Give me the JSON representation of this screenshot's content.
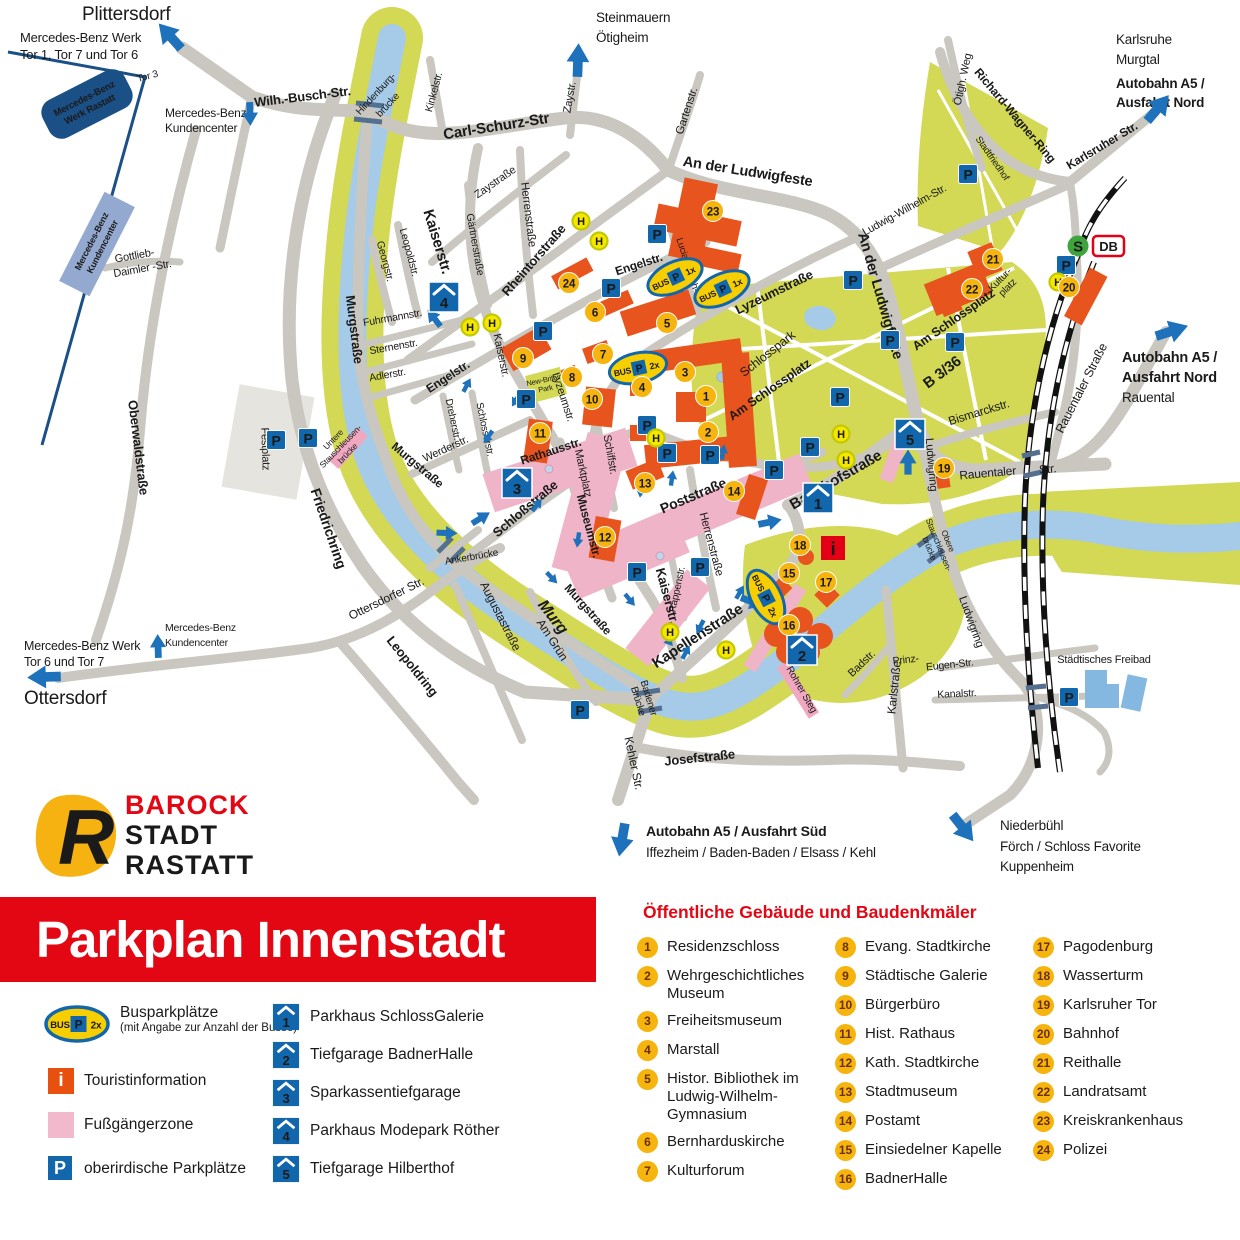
{
  "banner": {
    "title": "Parkplan Innenstadt"
  },
  "logo": {
    "word1": "BAROCK",
    "word2": "STADT",
    "word3": "RASTATT",
    "letter": "R"
  },
  "legend": {
    "bus_label": "Busparkplätze",
    "bus_sublabel": "(mit Angabe zur Anzahl der Busse)",
    "bus_word": "BUS",
    "p_letter": "P",
    "bus_count_legend": "2x",
    "touristinfo": "Touristinformation",
    "touristinfo_icon": "i",
    "fussgaengerzone": "Fußgängerzone",
    "parkplaetze": "oberirdische Parkplätze"
  },
  "garages": [
    {
      "num": "1",
      "name": "Parkhaus SchlossGalerie"
    },
    {
      "num": "2",
      "name": "Tiefgarage BadnerHalle"
    },
    {
      "num": "3",
      "name": "Sparkassentiefgarage"
    },
    {
      "num": "4",
      "name": "Parkhaus Modepark Röther"
    },
    {
      "num": "5",
      "name": "Tiefgarage Hilberthof"
    }
  ],
  "buildings": {
    "heading": "Öffentliche Gebäude und Baudenkmäler",
    "items": [
      {
        "num": "1",
        "name": "Residenzschloss"
      },
      {
        "num": "2",
        "name": "Wehrgeschichtliches Museum"
      },
      {
        "num": "3",
        "name": "Freiheitsmuseum"
      },
      {
        "num": "4",
        "name": "Marstall"
      },
      {
        "num": "5",
        "name": "Histor. Bibliothek im Ludwig-Wilhelm-Gymnasium"
      },
      {
        "num": "6",
        "name": "Bernharduskirche"
      },
      {
        "num": "7",
        "name": "Kulturforum"
      },
      {
        "num": "8",
        "name": "Evang. Stadtkirche"
      },
      {
        "num": "9",
        "name": "Städtische Galerie"
      },
      {
        "num": "10",
        "name": "Bürgerbüro"
      },
      {
        "num": "11",
        "name": "Hist. Rathaus"
      },
      {
        "num": "12",
        "name": "Kath. Stadtkirche"
      },
      {
        "num": "13",
        "name": "Stadtmuseum"
      },
      {
        "num": "14",
        "name": "Postamt"
      },
      {
        "num": "15",
        "name": "Einsiedelner Kapelle"
      },
      {
        "num": "16",
        "name": "BadnerHalle"
      },
      {
        "num": "17",
        "name": "Pagodenburg"
      },
      {
        "num": "18",
        "name": "Wasserturm"
      },
      {
        "num": "19",
        "name": "Karlsruher Tor"
      },
      {
        "num": "20",
        "name": "Bahnhof"
      },
      {
        "num": "21",
        "name": "Reithalle"
      },
      {
        "num": "22",
        "name": "Landratsamt"
      },
      {
        "num": "23",
        "name": "Kreiskrankenhaus"
      },
      {
        "num": "24",
        "name": "Polizei"
      }
    ]
  },
  "map": {
    "p_letter": "P",
    "h_letter": "H",
    "info_icon": "i",
    "station": {
      "s": "S",
      "db": "DB"
    },
    "bus_stops": [
      {
        "count": "1x"
      },
      {
        "count": "1x"
      },
      {
        "count": "2x"
      },
      {
        "count": "2x"
      }
    ],
    "streets": {
      "wilh_busch": "Wilh.-Busch-Str.",
      "hindenburg1": "Hindenburg-",
      "hindenburg2": "brücke",
      "carl_schurz": "Carl-Schurz-Str",
      "zaystr": "Zaystr.",
      "zaystrasse": "Zaystraße",
      "kinkelstr": "Kinkelstr.",
      "gartenstr": "Gartenstr.",
      "ludwigfeste": "An der Ludwigfeste",
      "herrenstrasse": "Herrenstraße",
      "kaiserstr": "Kaiserstr.",
      "gaertnerstrasse": "Gärtnerstraße",
      "leopoldstr": "Leopoldstr.",
      "georgstr": "Georgstr.",
      "fuhrmannstr": "Fuhrmannstr.",
      "sternenstr": "Sternenstr.",
      "adlerstr": "Adlerstr.",
      "rheintorstrasse": "Rheintorstraße",
      "engelstr": "Engelstr.",
      "lucian_reich": "Lucian-Reich-Str.",
      "lyzeumstrasse": "Lyzeumstraße",
      "lyzeumstr": "Lyzeumstr.",
      "murgstrasse": "Murgstraße",
      "murg": "Murg",
      "werderstr": "Werderstr.",
      "dreherstr": "Dreherstr.",
      "schlosserstr": "Schlosserstr.",
      "schlossstrasse": "Schloßstraße",
      "rathausstr": "Rathausstr.",
      "marktplatz": "Marktplatz",
      "schiffstr": "Schiffstr.",
      "museumstr": "Museumstr.",
      "poststrasse": "Poststraße",
      "rappenstr": "Rappenstr.",
      "kapellenstrasse": "Kapellenstraße",
      "josefstrasse": "Josefstraße",
      "kehler_str": "Kehler Str.",
      "badener1": "Badener",
      "badener2": "Brücke",
      "ankerbruecke": "Ankerbrücke",
      "ottersdorfer_str": "Ottersdorfer Str.",
      "leopoldring": "Leopoldring",
      "augustastrasse": "Augustastraße",
      "am_gruen": "Am Grün",
      "friedrichring": "Friedrichring",
      "oberwaldstrasse": "Oberwaldstraße",
      "bahnhofstrasse": "Bahnhofstraße",
      "ludwigring": "Ludwigring",
      "rauentaler": "Rauentaler",
      "str_abbr": "Str.",
      "rauentaler_strasse": "Rauentaler Straße",
      "b336": "B 3/36",
      "bismarckstr": "Bismarckstr.",
      "am_schlossplatz": "Am Schlossplatz",
      "schlosspark": "Schlosspark",
      "kultur1": "Kultur-",
      "kultur2": "platz",
      "stadtfriedhof": "Stadtfriedhof",
      "richard_wagner": "Richard-Wagner-Ring",
      "oetigh_weg": "Ötigh. Weg",
      "karlsruher_str": "Karlsruher Str.",
      "ludwig_wilhelm": "Ludwig-Wilhelm-Str.",
      "karlstrasse": "Karlstraße",
      "badstr": "Badstr.",
      "prinz": "Prinz-",
      "eugen": "Eugen-Str.",
      "kanalstr": "Kanalstr.",
      "gottlieb1": "Gottlieb-",
      "gottlieb2": "Daimler -Str.",
      "rohrer_steg": "Rohrer Steg",
      "untere1": "Untere",
      "untere2": "Stauschleusen-",
      "untere3": "brücke",
      "obere1": "Obere",
      "obere2": "Stauschleusen-",
      "obere3": "brücke",
      "festplatz": "Festplatz",
      "new_britain1": "New-Britain-",
      "new_britain2": "Park"
    },
    "labels": {
      "plittersdorf": "Plittersdorf",
      "mb_nord1": "Mercedes-Benz Werk",
      "mb_nord2": "Tor 1, Tor 7 und Tor 6",
      "tor3": "Tor 3",
      "mb_box1": "Mercedes-Benz",
      "mb_box2": "Werk Rastatt",
      "kc1": "Mercedes-Benz",
      "kc2": "Kundencenter",
      "steinmauern": "Steinmauern",
      "oetigheim": "Ötigheim",
      "karlsruhe": "Karlsruhe",
      "murgtal": "Murgtal",
      "a5": "Autobahn A5 /",
      "ausfahrt_nord": "Ausfahrt Nord",
      "rauental": "Rauental",
      "mb_sued1": "Mercedes-Benz Werk",
      "mb_sued2": "Tor 6 und Tor 7",
      "ottersdorf": "Ottersdorf",
      "a5_sued": "Autobahn A5 / Ausfahrt Süd",
      "a5_sued_dest": "Iffezheim / Baden-Baden / Elsass / Kehl",
      "niederbuehl": "Niederbühl",
      "foerch": "Förch / Schloss Favorite",
      "kuppenheim": "Kuppenheim",
      "freibad": "Städtisches Freibad"
    }
  },
  "colors": {
    "banner_red": "#e30613",
    "building_orange": "#e8541d",
    "marker_yellow": "#f6b40e",
    "park_green": "#d3d855",
    "river_blue": "#a5cbe9",
    "pedestrian_pink": "#f0b4c8",
    "parking_blue": "#1266ab",
    "sbahn_green": "#3fa43c",
    "db_red": "#e30016"
  }
}
